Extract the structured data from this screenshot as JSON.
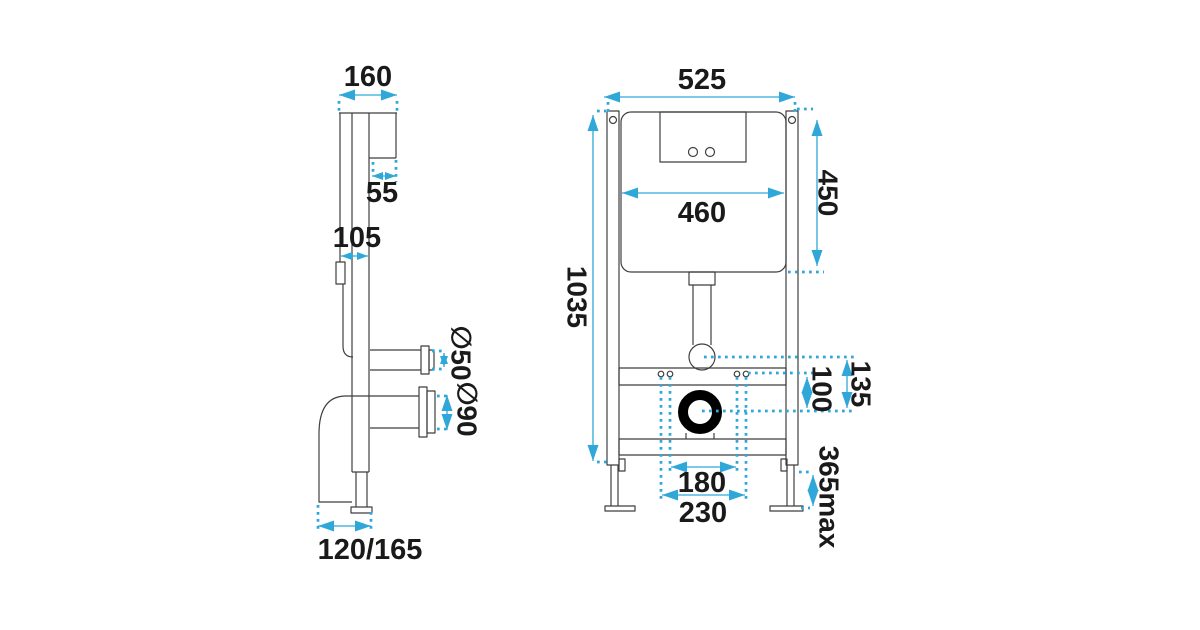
{
  "colors": {
    "accent": "#2fa8d9",
    "line": "#3f3f3f",
    "text": "#1a1a1a",
    "waste_outlet": "#000000",
    "background": "#ffffff"
  },
  "side_view": {
    "overall_depth": "160",
    "wall_bracket_depth": "55",
    "rail_depth": "105",
    "flush_pipe_diameter": "∅50",
    "waste_pipe_diameter": "∅90",
    "floor_outlet_projection": "120/165"
  },
  "front_view": {
    "overall_width": "525",
    "cistern_width": "460",
    "cistern_height": "450",
    "frame_height": "1035",
    "flush_to_waste_offset": "135",
    "fixing_to_waste_offset": "100",
    "waste_bracket_spacing": "180",
    "fixing_bolt_spacing": "230",
    "leg_adjustment_max": "365max"
  }
}
